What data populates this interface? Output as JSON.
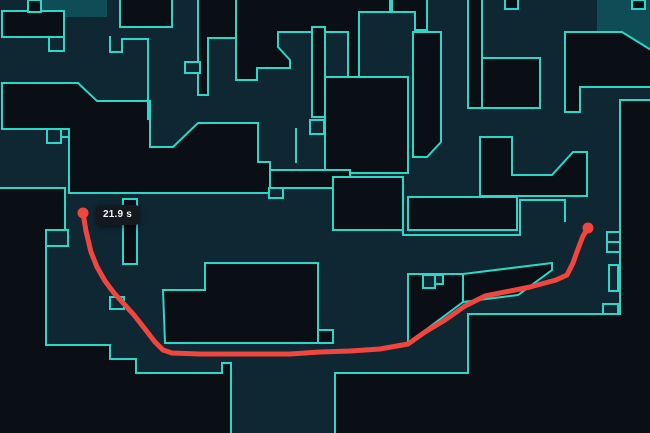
{
  "map": {
    "name": "tactical-map",
    "colors": {
      "outline": "#2bd7c6",
      "floor": "#0e2733",
      "void": "#0a0e15",
      "spawn_zone": "#0e4d56",
      "route": "#f0463e",
      "tooltip_bg": "#15181d",
      "tooltip_text": "#f4f6f7"
    }
  },
  "route": {
    "time_label": "21.9 s",
    "start": {
      "x": 83,
      "y": 213
    },
    "end": {
      "x": 588,
      "y": 228
    },
    "dot_radius": 5.5,
    "points": [
      [
        83,
        213
      ],
      [
        86,
        231
      ],
      [
        91,
        252
      ],
      [
        97,
        267
      ],
      [
        105,
        281
      ],
      [
        114,
        293
      ],
      [
        124,
        304
      ],
      [
        134,
        315
      ],
      [
        145,
        329
      ],
      [
        155,
        342
      ],
      [
        163,
        350
      ],
      [
        172,
        353
      ],
      [
        200,
        354
      ],
      [
        245,
        354
      ],
      [
        290,
        354
      ],
      [
        320,
        352
      ],
      [
        350,
        351
      ],
      [
        380,
        349
      ],
      [
        408,
        344
      ],
      [
        425,
        332
      ],
      [
        445,
        320
      ],
      [
        465,
        306
      ],
      [
        485,
        296
      ],
      [
        505,
        292
      ],
      [
        530,
        287
      ],
      [
        556,
        280
      ],
      [
        567,
        275
      ],
      [
        573,
        263
      ],
      [
        578,
        249
      ],
      [
        583,
        236
      ],
      [
        588,
        228
      ]
    ]
  },
  "tooltip": {
    "text": "21.9 s",
    "x": 96,
    "y": 205
  }
}
